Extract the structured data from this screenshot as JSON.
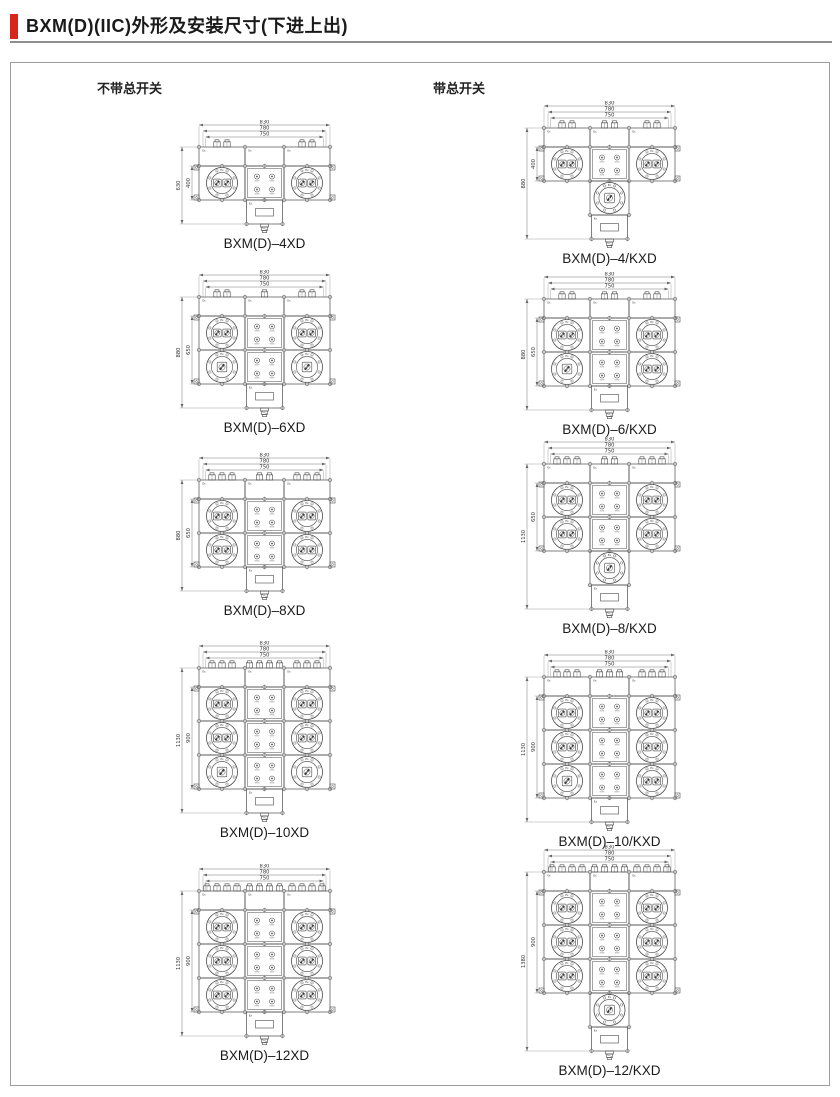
{
  "header": {
    "title": "BXM(D)(IIC)外形及安装尺寸(下进上出)"
  },
  "columns": {
    "left_heading": "不带总开关",
    "right_heading": "带总开关"
  },
  "colors": {
    "accent": "#d8261d",
    "line": "#4a4a4a",
    "dim_line": "#666666",
    "text": "#333333"
  },
  "misc": {
    "module_mark": "Ex"
  },
  "drawings": [
    {
      "label": "BXM(D)–4XD",
      "column": "left",
      "width_dims": [
        "830",
        "780",
        "750"
      ],
      "height_overall": "630",
      "height_inner": "400",
      "rows": [
        [
          2,
          2
        ]
      ],
      "main_switch_module": false,
      "top_glands": [
        2,
        0,
        2
      ]
    },
    {
      "label": "BXM(D)–6XD",
      "column": "left",
      "width_dims": [
        "830",
        "780",
        "750"
      ],
      "height_overall": "880",
      "height_inner": "650",
      "rows": [
        [
          2,
          2
        ],
        [
          1,
          1
        ]
      ],
      "main_switch_module": false,
      "top_glands": [
        2,
        1,
        2
      ]
    },
    {
      "label": "BXM(D)–8XD",
      "column": "left",
      "width_dims": [
        "830",
        "780",
        "750"
      ],
      "height_overall": "880",
      "height_inner": "650",
      "rows": [
        [
          2,
          2
        ],
        [
          2,
          2
        ]
      ],
      "main_switch_module": false,
      "top_glands": [
        3,
        2,
        3
      ]
    },
    {
      "label": "BXM(D)–10XD",
      "column": "left",
      "width_dims": [
        "830",
        "780",
        "750"
      ],
      "height_overall": "1130",
      "height_inner": "900",
      "rows": [
        [
          2,
          2
        ],
        [
          2,
          2
        ],
        [
          1,
          1
        ]
      ],
      "main_switch_module": false,
      "top_glands": [
        3,
        4,
        3
      ]
    },
    {
      "label": "BXM(D)–12XD",
      "column": "left",
      "width_dims": [
        "830",
        "780",
        "750"
      ],
      "height_overall": "1130",
      "height_inner": "900",
      "rows": [
        [
          2,
          2
        ],
        [
          2,
          2
        ],
        [
          2,
          2
        ]
      ],
      "main_switch_module": false,
      "top_glands": [
        4,
        4,
        4
      ]
    },
    {
      "label": "BXM(D)–4/KXD",
      "column": "right",
      "width_dims": [
        "830",
        "780",
        "750"
      ],
      "height_overall": "880",
      "height_inner": "400",
      "rows": [
        [
          2,
          2
        ]
      ],
      "main_switch_module": true,
      "top_glands": [
        2,
        2,
        2
      ]
    },
    {
      "label": "BXM(D)–6/KXD",
      "column": "right",
      "width_dims": [
        "830",
        "780",
        "750"
      ],
      "height_overall": "880",
      "height_inner": "650",
      "rows": [
        [
          2,
          2
        ],
        [
          1,
          2
        ]
      ],
      "main_switch_module": false,
      "top_glands": [
        2,
        2,
        2
      ]
    },
    {
      "label": "BXM(D)–8/KXD",
      "column": "right",
      "width_dims": [
        "830",
        "780",
        "750"
      ],
      "height_overall": "1130",
      "height_inner": "650",
      "rows": [
        [
          2,
          2
        ],
        [
          2,
          2
        ]
      ],
      "main_switch_module": true,
      "top_glands": [
        3,
        2,
        3
      ]
    },
    {
      "label": "BXM(D)–10/KXD",
      "column": "right",
      "width_dims": [
        "830",
        "780",
        "750"
      ],
      "height_overall": "1130",
      "height_inner": "900",
      "rows": [
        [
          2,
          2
        ],
        [
          2,
          2
        ],
        [
          1,
          2
        ]
      ],
      "main_switch_module": false,
      "top_glands": [
        3,
        3,
        3
      ]
    },
    {
      "label": "BXM(D)–12/KXD",
      "column": "right",
      "width_dims": [
        "830",
        "780",
        "750"
      ],
      "height_overall": "1380",
      "height_inner": "900",
      "rows": [
        [
          2,
          2
        ],
        [
          2,
          2
        ],
        [
          2,
          2
        ]
      ],
      "main_switch_module": true,
      "top_glands": [
        4,
        4,
        4
      ]
    }
  ]
}
